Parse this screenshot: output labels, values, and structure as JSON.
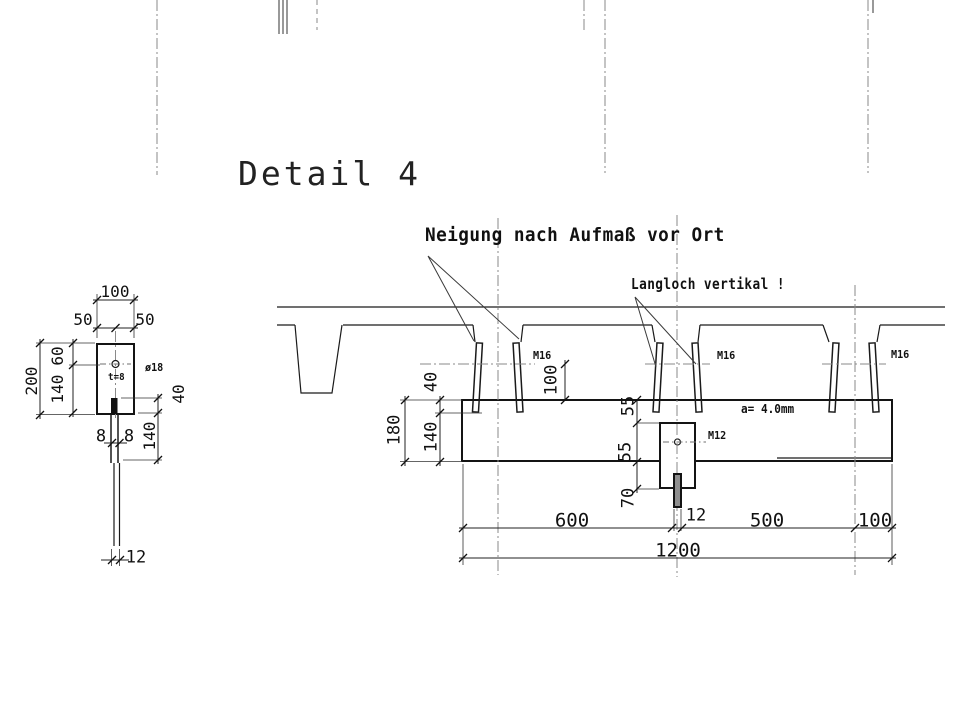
{
  "title": "Detail 4",
  "annotations": {
    "slope_note": "Neigung nach Aufmaß vor Ort",
    "slot_note": "Langloch vertikal !",
    "weld_spec": "a= 4.0mm"
  },
  "side_view": {
    "labels": {
      "plate_thickness": "t=8",
      "hole_diameter": "ø18"
    },
    "dims": {
      "plate_width": "100",
      "width_left": "50",
      "width_right": "50",
      "plate_height": "200",
      "hole_offset_top": "60",
      "hole_to_bottom": "140",
      "bar_overlap": "40",
      "bar_length": "140",
      "bar_thickness_left": "8",
      "bar_thickness_right": "8",
      "bar_width": "12"
    }
  },
  "section_view": {
    "bolt_labels": [
      "M16",
      "M16",
      "M16"
    ],
    "rod_label": "M12",
    "dims": {
      "beam_height": "180",
      "anchor_embed": "40",
      "embed_rest": "140",
      "slot_height": "100",
      "plate_seg_top": "55",
      "plate_seg_mid": "55",
      "plate_seg_bottom": "70",
      "rod_width": "12",
      "span_left": "600",
      "span_right": "500",
      "span_edge": "100",
      "span_total": "1200"
    }
  }
}
